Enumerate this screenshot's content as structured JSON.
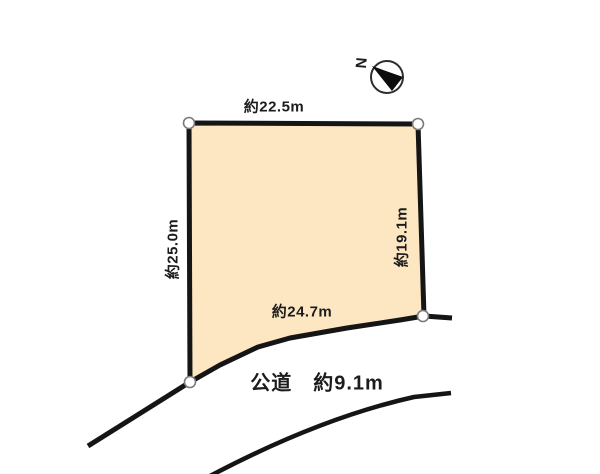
{
  "page": {
    "background_color": "#ffffff"
  },
  "diagram": {
    "parcel": {
      "fill_color": "#fde6c2",
      "outline_color": "#151515",
      "edge_labels": {
        "top": "約22.5m",
        "left": "約25.0m",
        "right": "約19.1m",
        "bottom": "約24.7m"
      }
    },
    "road": {
      "label": "公道　約9.1m"
    },
    "compass": {
      "north_label": "N"
    },
    "colors": {
      "line_color": "#151515",
      "corner_marker_fill": "#ffffff",
      "corner_marker_stroke": "#7a7a7a"
    }
  }
}
